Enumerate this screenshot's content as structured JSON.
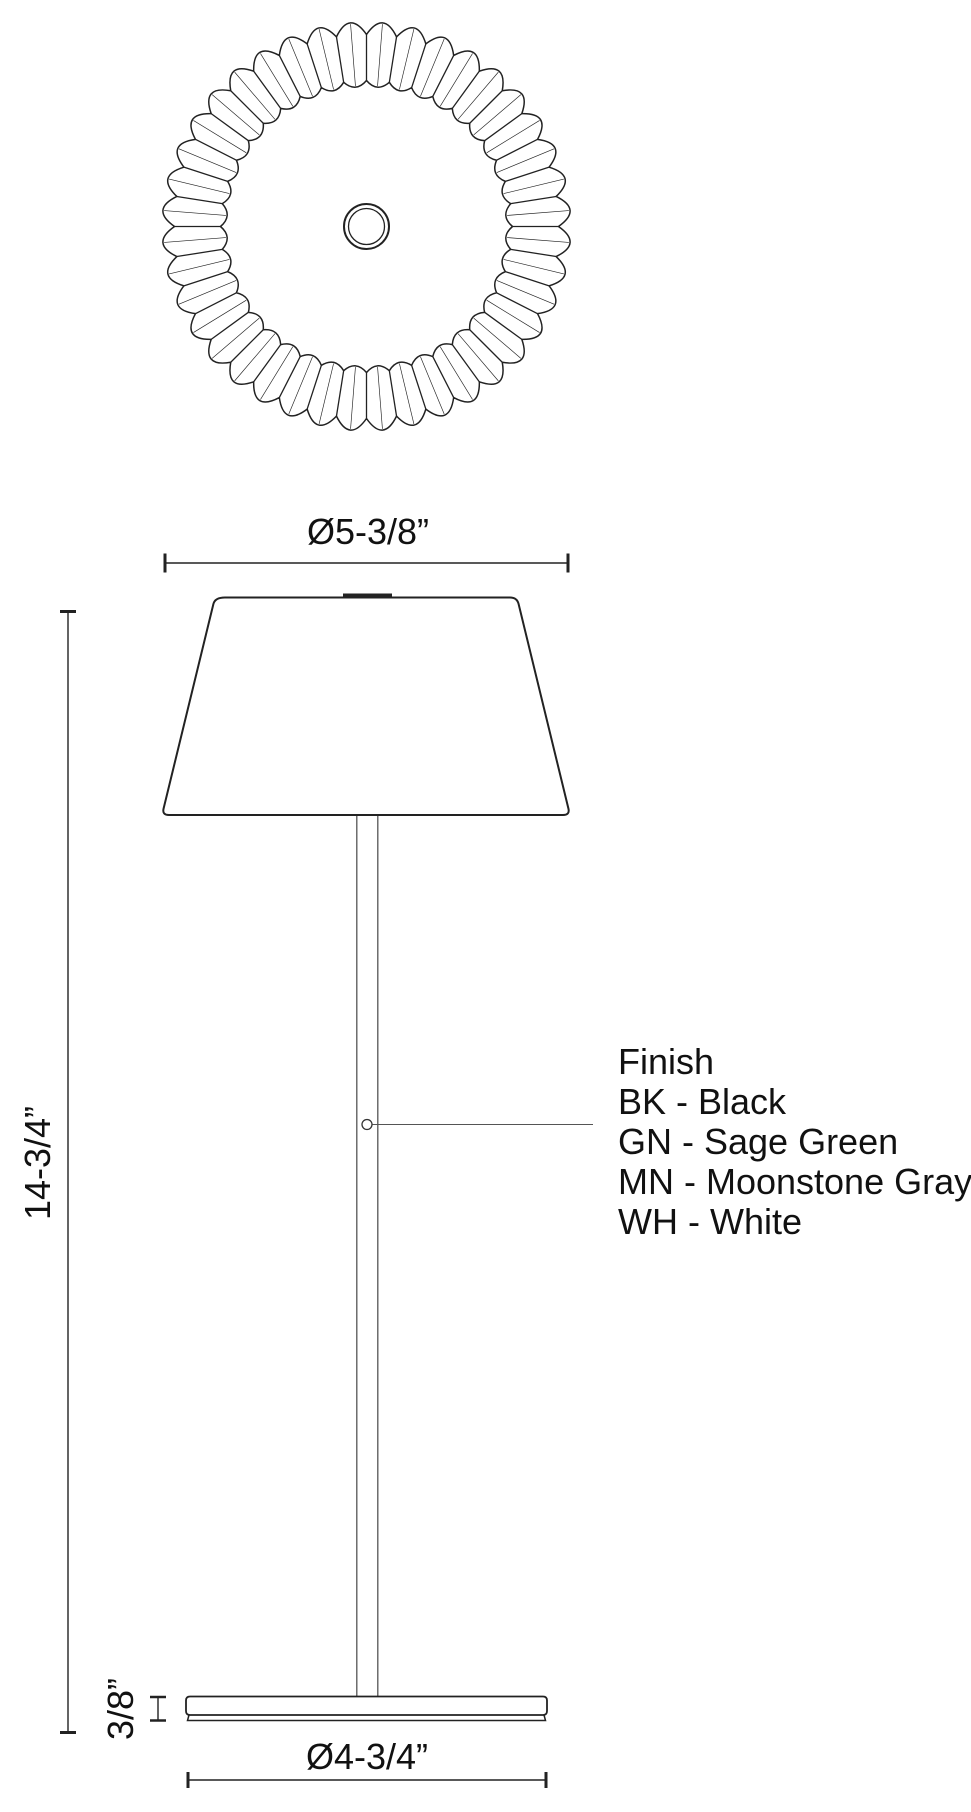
{
  "colors": {
    "line": "#222222",
    "stem_line": "#555555",
    "text": "#111111",
    "background": "#ffffff"
  },
  "dimension_labels": {
    "shade_diameter": "Ø5-3/8”",
    "overall_height": "14-3/4”",
    "base_thickness": "3/8”",
    "base_diameter": "Ø4-3/4”"
  },
  "finish_legend": {
    "title": "Finish",
    "options": [
      {
        "code": "BK",
        "color_name": "Black",
        "label": "BK - Black"
      },
      {
        "code": "GN",
        "color_name": "Sage Green",
        "label": "GN - Sage Green"
      },
      {
        "code": "MN",
        "color_name": "Moonstone Gray",
        "label": "MN - Moonstone Gray"
      },
      {
        "code": "WH",
        "color_name": "White",
        "label": "WH - White"
      }
    ]
  }
}
